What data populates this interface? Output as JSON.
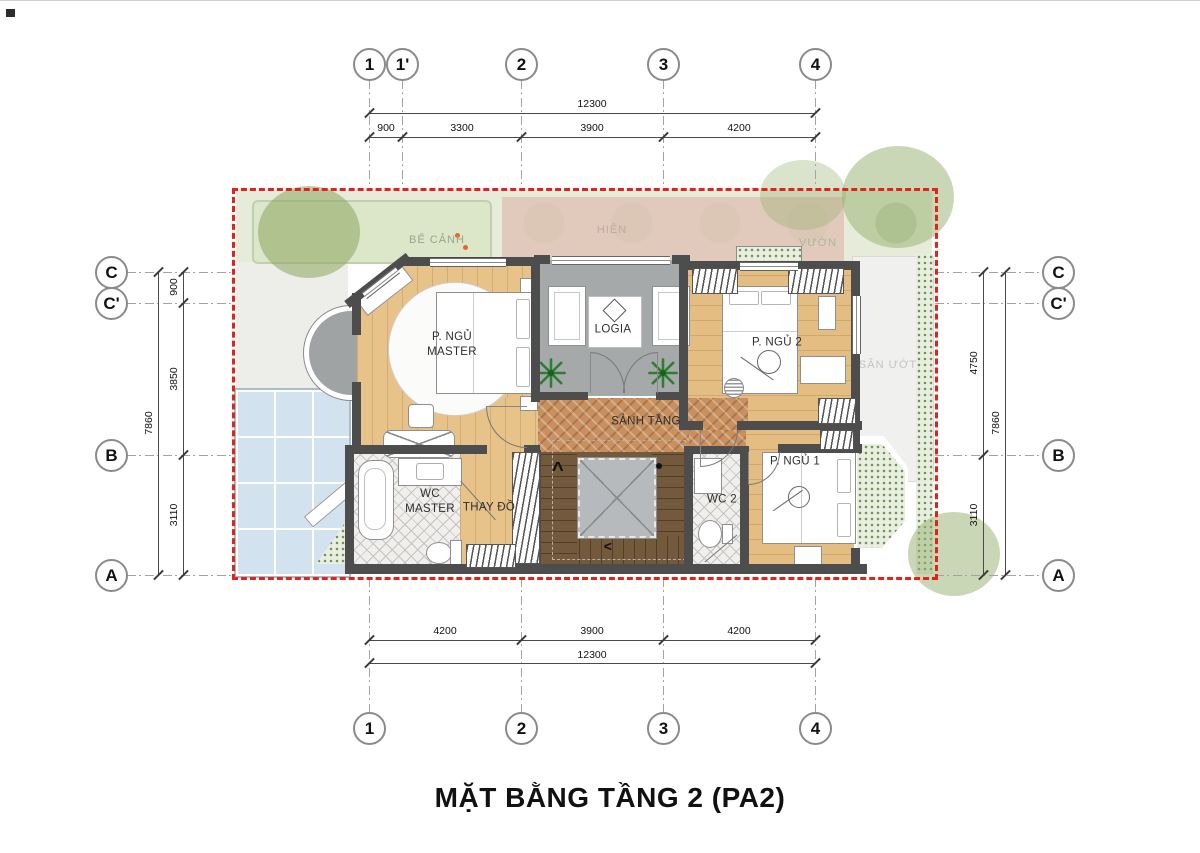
{
  "sheet": {
    "title": "MẶT BẰNG TẦNG 2 (PA2)"
  },
  "axes": {
    "top": [
      "1",
      "1'",
      "2",
      "3",
      "4"
    ],
    "bottom": [
      "1",
      "2",
      "3",
      "4"
    ],
    "left": [
      "C",
      "C'",
      "B",
      "A"
    ],
    "right": [
      "C",
      "C'",
      "B",
      "A"
    ]
  },
  "dims": {
    "top_total": "12300",
    "top_segs": [
      "900",
      "3300",
      "3900",
      "4200"
    ],
    "bottom_segs": [
      "4200",
      "3900",
      "4200"
    ],
    "bottom_total": "12300",
    "left_total": "7860",
    "left_segs": [
      "900",
      "3850",
      "3110"
    ],
    "right_segs": [
      "4750",
      "3110"
    ],
    "right_total": "7860"
  },
  "rooms": {
    "master_line1": "P. NGỦ",
    "master_line2": "MASTER",
    "logia": "LOGIA",
    "bedroom2": "P. NGỦ 2",
    "hall": "SẢNH TẦNG",
    "wc_master_line1": "WC",
    "wc_master_line2": "MASTER",
    "dressing": "THAY ĐỒ",
    "wc2": "WC 2",
    "bedroom1": "P. NGỦ 1"
  },
  "site": {
    "pond": "BỂ CẢNH",
    "porch": "HIÊN",
    "garden": "VƯỜN",
    "wet_yard": "SÂN ƯỚT"
  },
  "stairs": {
    "up": "^",
    "down": "<"
  },
  "colors": {
    "boundary_red": "#E2231A",
    "wall": "#4D4D4D",
    "wood_floor": "#E6C189",
    "herringbone_floor": "#C9905F",
    "stair_wood": "#745A3C",
    "logia_floor": "#A5A9AA",
    "glass_roof": "#D3E2EF",
    "garden_green": "#E6ECD9",
    "terrace_pink": "#DFC4B6",
    "plant_green": "#2E7D32"
  }
}
